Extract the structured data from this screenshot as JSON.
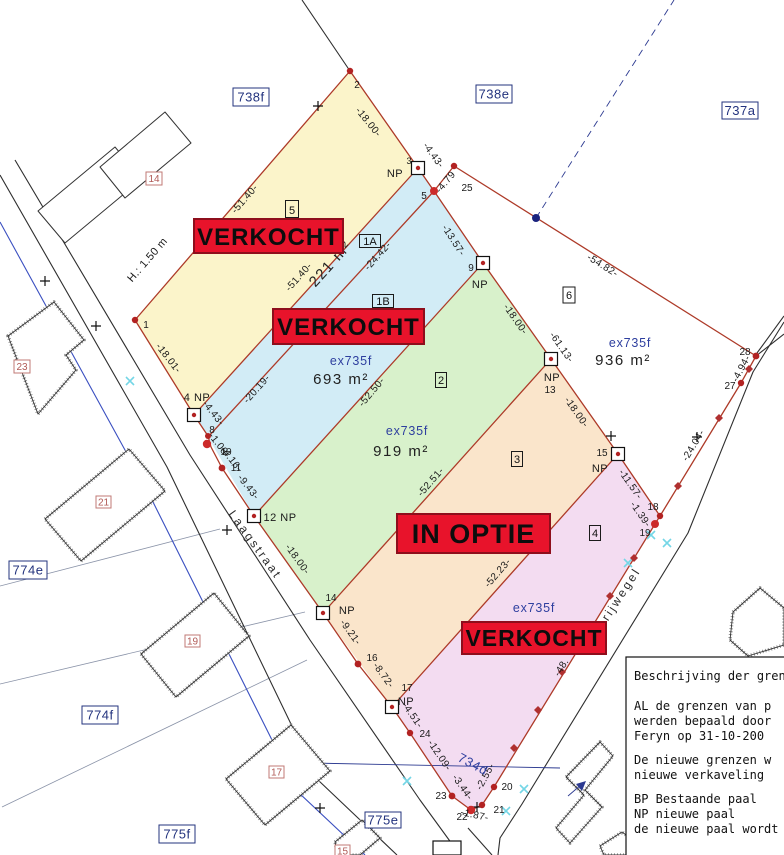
{
  "lots": {
    "lot5": {
      "id": "5"
    },
    "lot1a": {
      "id": "1A",
      "area": "221 m²"
    },
    "lot1b": {
      "id": "1B",
      "old_parcel": "ex735f",
      "area": "693 m²"
    },
    "lot2": {
      "id": "2",
      "old_parcel": "ex735f",
      "area": "919 m²"
    },
    "lot3": {
      "id": "3"
    },
    "lot4": {
      "id": "4",
      "old_parcel": "ex735f"
    },
    "lot6": {
      "id": "6",
      "old_parcel": "ex735f",
      "area": "936 m²"
    }
  },
  "banners": {
    "top": "VERKOCHT",
    "middle": "VERKOCHT",
    "option": "IN OPTIE",
    "bottom": "VERKOCHT"
  },
  "streets": {
    "main": "Laagstraat",
    "side": "erijwegel"
  },
  "neighbor_parcels": {
    "p738f": "738f",
    "p738e": "738e",
    "p737a": "737a",
    "p774e": "774e",
    "p774f": "774f",
    "p775f": "775f",
    "p775e": "775e"
  },
  "house_numbers": {
    "h14": "14",
    "h23": "23",
    "h21": "21",
    "h19": "19",
    "h17": "17",
    "h15": "15"
  },
  "old_boundary_label": "734d",
  "height_note": "H.: 1.50 m",
  "status_colors": {
    "banner_red": "#e8132b",
    "boundary_red": "#ad3a28",
    "parcel_blue_text": "#2e3f9f"
  },
  "dims": {
    "d01": "-51.40-",
    "d02": "-18.00-",
    "d03": "-4.43-",
    "d04": "-4.79",
    "d05": "-13.57-",
    "d06": "-54.82-",
    "d07": "-51.40-",
    "d08": "-24.42-",
    "d09": "-20.19-",
    "d10": "-52.50-",
    "d11": "-52.51-",
    "d12": "-52.23-",
    "d13": "-18.01-",
    "d14": "-4.43-",
    "d15": "-1.08-",
    "d16": "-4.16-",
    "d17": "-9.43-",
    "d18": "-18.00-",
    "d19": "-9.21-",
    "d20": "-8.72-",
    "d21": "-4.51-",
    "d22": "-12.09-",
    "d23": "-3.44-",
    "d24": "-2.55-",
    "d25": "-1.87-",
    "d26": "-18.00-",
    "d27": "-61.13-",
    "d28": "-18.00-",
    "d29": "-11.57-",
    "d30": "-1.39-",
    "d31": "-4.94-",
    "d32": "-24.04-",
    "d33": "-48."
  },
  "points": {
    "p1": "1",
    "p2": "2",
    "p3": "3",
    "p4np": "4 NP",
    "p5": "5",
    "p8": "8",
    "p9": "9",
    "p10": "10",
    "p11": "11",
    "p12np": "12 NP",
    "p13": "13",
    "p14": "14",
    "p15": "15",
    "p16": "16",
    "p17": "17",
    "p18": "18",
    "p19": "19",
    "p20": "20",
    "p21": "21",
    "p22": "22",
    "p23": "23",
    "p24": "24",
    "p25": "25",
    "p27": "27",
    "p28": "28",
    "np": "NP"
  },
  "notes": {
    "line1": "Beschrijving der gren",
    "line2": "AL de grenzen van p",
    "line3": "werden bepaald door",
    "line4": "Feryn op 31-10-200",
    "line5": "De nieuwe grenzen w",
    "line6": "nieuwe verkaveling",
    "line7": "BP Bestaande paal",
    "line8": "NP nieuwe paal",
    "line9": "de nieuwe paal wordt"
  }
}
